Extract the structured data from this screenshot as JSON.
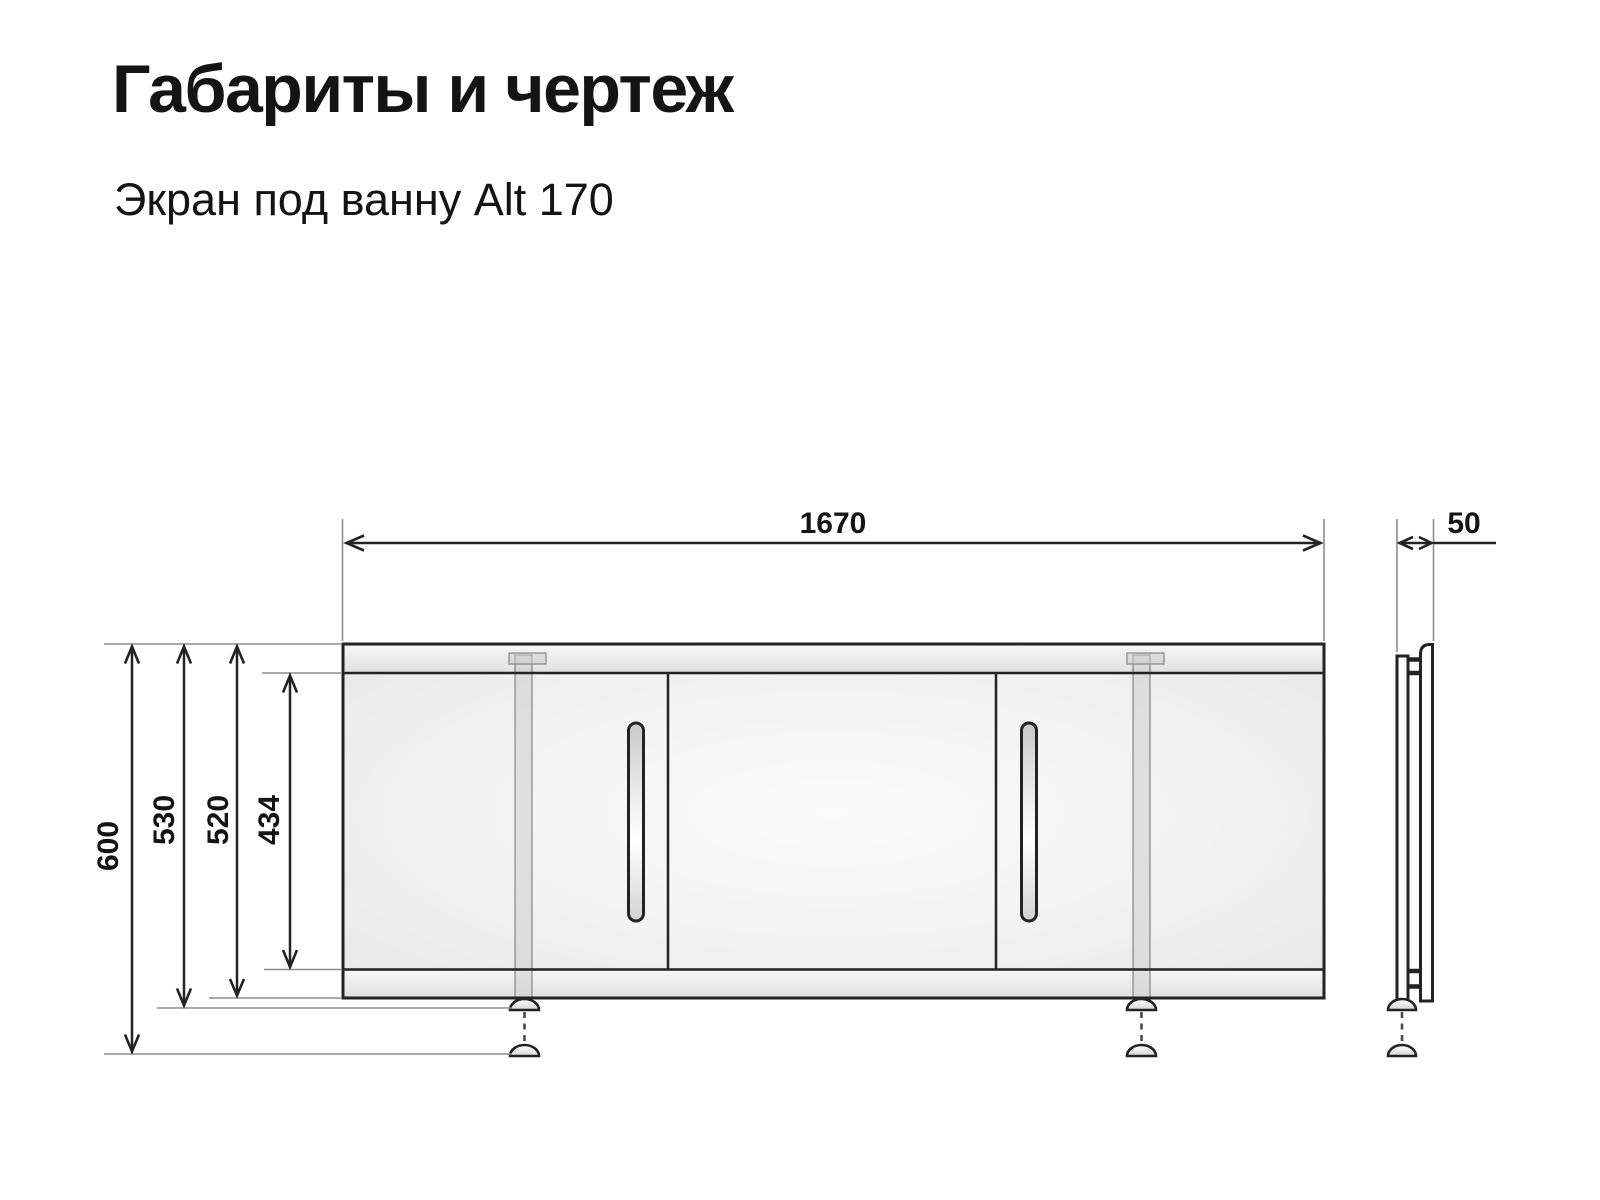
{
  "header": {
    "title": "Габариты и чертеж",
    "subtitle": "Экран под ванну Alt 170"
  },
  "dimensions": {
    "width": "1670",
    "depth": "50",
    "height_total": "600",
    "height_with_foot": "530",
    "height_panel": "520",
    "height_door": "434"
  },
  "colors": {
    "background": "#ffffff",
    "text": "#141414",
    "outline": "#232323",
    "extension_line": "#8d8d8d"
  }
}
